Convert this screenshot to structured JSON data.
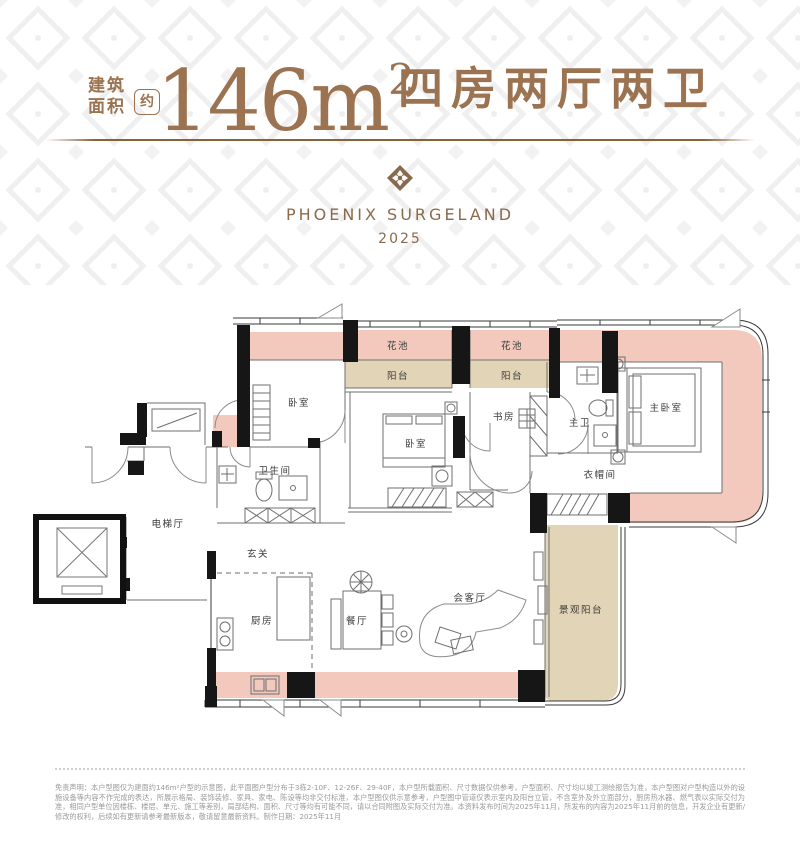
{
  "header": {
    "area_label_top": "建筑",
    "area_label_bottom": "面积",
    "approx": "约",
    "area_number": "146m",
    "area_exponent": "2",
    "rooms_title": "四房两厅两卫"
  },
  "brand": {
    "name": "PHOENIX SURGELAND",
    "year": "2025"
  },
  "floorplan": {
    "labels": [
      {
        "text": "花池"
      },
      {
        "text": "花池"
      },
      {
        "text": "阳台"
      },
      {
        "text": "阳台"
      },
      {
        "text": "卧室"
      },
      {
        "text": "卫生间"
      },
      {
        "text": "电梯厅"
      },
      {
        "text": "玄关"
      },
      {
        "text": "厨房"
      },
      {
        "text": "餐厅"
      },
      {
        "text": "会客厅"
      },
      {
        "text": "书房"
      },
      {
        "text": "卧室"
      },
      {
        "text": "主卫"
      },
      {
        "text": "主卧室"
      },
      {
        "text": "衣帽间"
      },
      {
        "text": "景观阳台"
      }
    ]
  },
  "disclaimer": {
    "text": "免责声明：本户型图仅为建面约146m²户型的示意图，此平面图户型分布于3栋2-10F、12-26F、29-40F，本户型所载面积、尺寸数据仅供参考，户型面积、尺寸均以竣工测绘报告为准，本户型图对户型构造以外的设施设备等内容不作完成的表达，所展示格局、装饰装修、家具、家电、陈设等均非交付标准，本户型图仅供示意参考，户型图中管道仅表示室内及阳台立管，不含室外及外立面部分，厨房热水器、燃气表以实际交付为准，相同户型单位因楼栋、楼层、单元、施工等差别，局部结构、面积、尺寸等均有可能不同，请以合同附图及实际交付为准。本资料发布时间为2025年11月，所发布的内容为2025年11月前的信息，开发企业有更新/修改的权利，后续如有更新请参考最新版本，敬请留意最新资料。制作日期：2025年11月"
  },
  "colors": {
    "accent_brown": "#9b7351",
    "pink": "#f2c9bc",
    "beige": "#e2d4b6",
    "wall_black": "#161616"
  }
}
